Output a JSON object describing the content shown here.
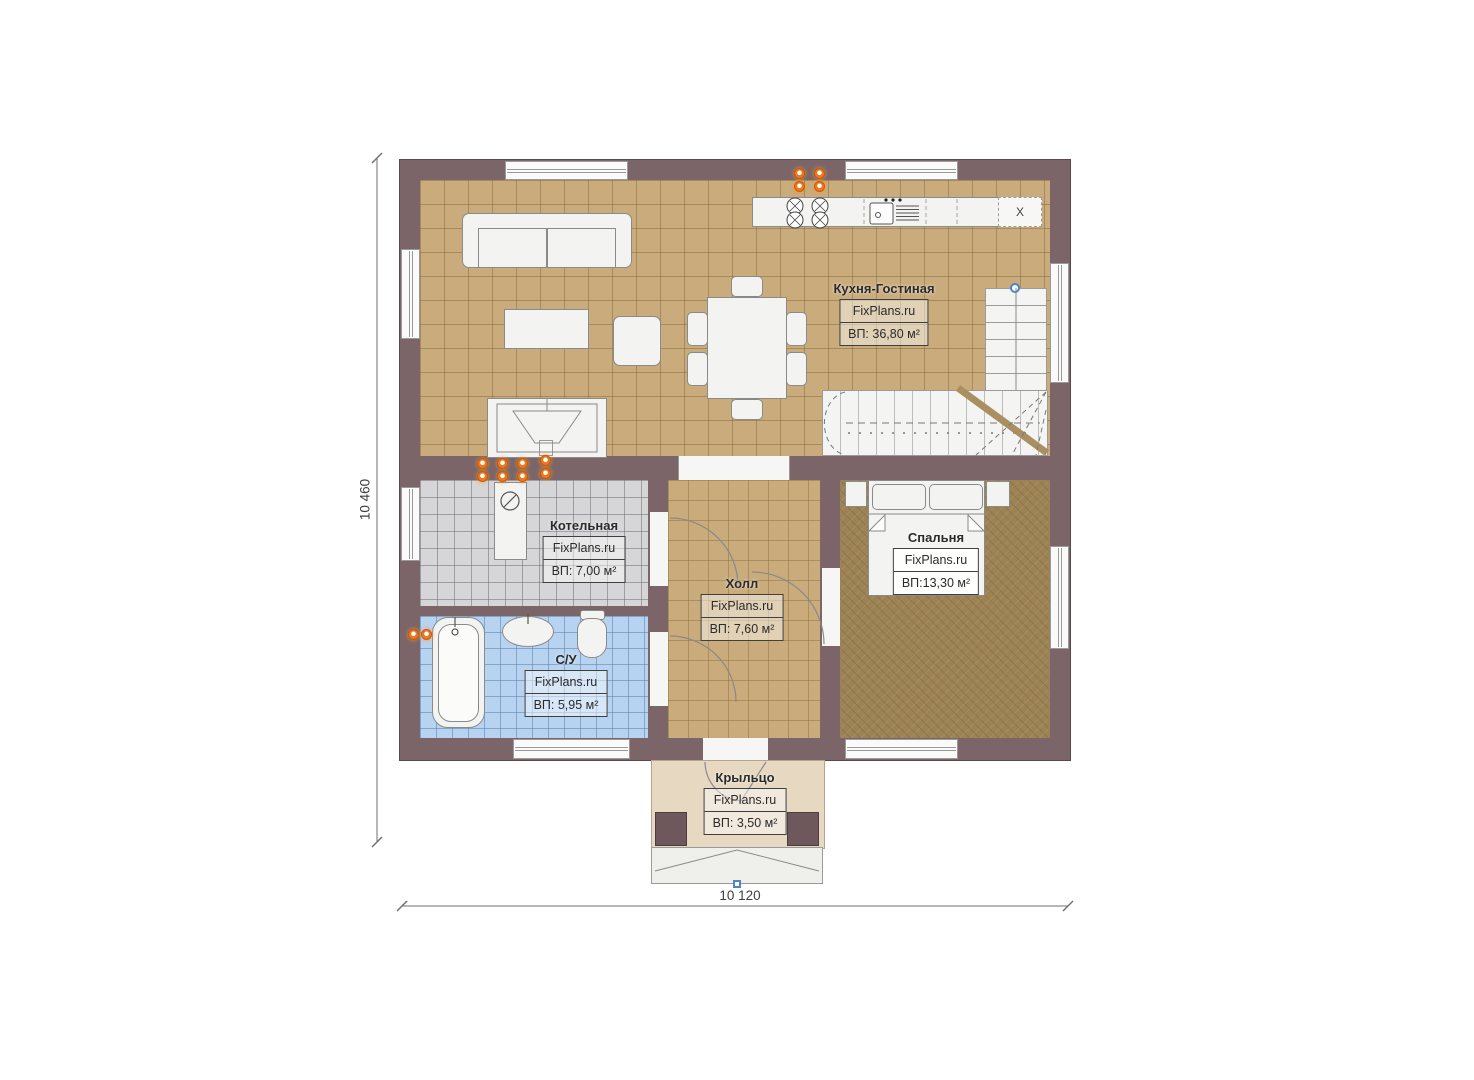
{
  "plan": {
    "brand_watermark": "FixPlans.ru",
    "rooms": {
      "kitchen": {
        "name": "Кухня-Гостиная",
        "brand": "FixPlans.ru",
        "area": "ВП: 36,80 м²"
      },
      "boiler": {
        "name": "Котельная",
        "brand": "FixPlans.ru",
        "area": "ВП: 7,00 м²"
      },
      "hall": {
        "name": "Холл",
        "brand": "FixPlans.ru",
        "area": "ВП: 7,60 м²"
      },
      "bathroom": {
        "name": "С/У",
        "brand": "FixPlans.ru",
        "area": "ВП: 5,95 м²"
      },
      "bedroom": {
        "name": "Спальня",
        "brand": "FixPlans.ru",
        "area": "ВП:13,30 м²"
      },
      "porch": {
        "name": "Крыльцо",
        "brand": "FixPlans.ru",
        "area": "ВП: 3,50 м²"
      }
    },
    "dimensions": {
      "left_total": "10 460",
      "bottom_total": "10 120"
    },
    "fixtures": {
      "fridge_label": "X"
    },
    "icons": {
      "socket-icon": "orange double-dot gas/electric point",
      "stair-entry-marker": "blue circle",
      "porch-axis-marker": "blue square"
    },
    "colors": {
      "wall": "#7b6568",
      "kitchen_floor": "#c9ab7c",
      "boiler_floor": "#d6d6d8",
      "bathroom_floor": "#b7d3f0",
      "bedroom_floor": "#9d8354",
      "porch_floor": "#e6d8c1",
      "accent_orange": "#f07818",
      "marker_blue": "#4a85c8"
    }
  }
}
